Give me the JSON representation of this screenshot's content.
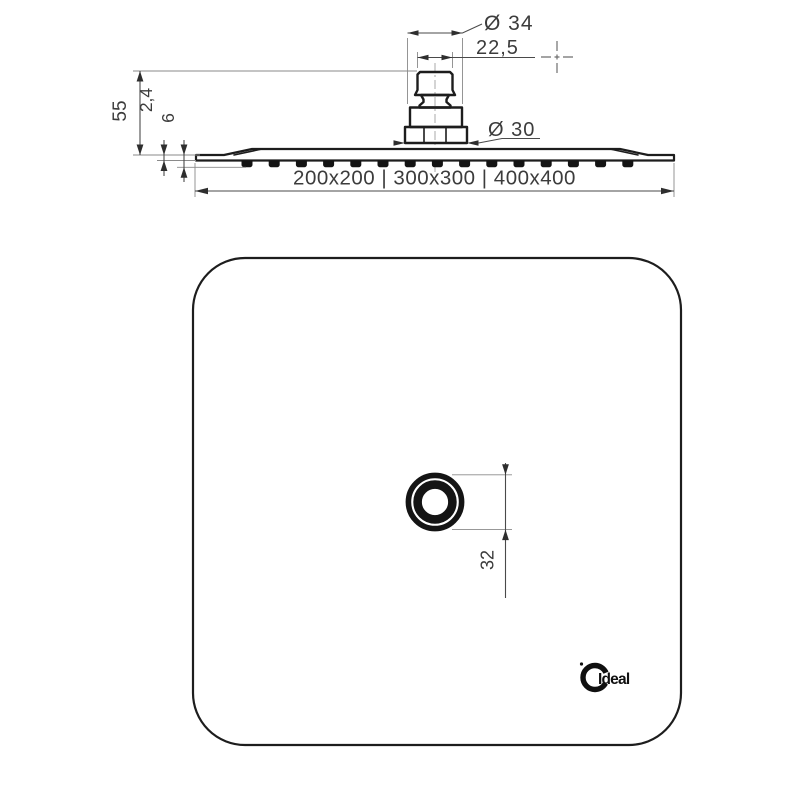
{
  "drawing": {
    "kind": "technical-drawing",
    "subject": "square-rain-shower-head"
  },
  "side_view": {
    "dim_inlet_diameter": "Ø 34",
    "dim_inlet_width": "22,5",
    "dim_connector_diameter": "Ø 30",
    "dim_total_height": "55",
    "dim_plate_thickness": "2,4",
    "dim_plate_with_nozzles": "6",
    "sizes_label": "200x200 | 300x300 | 400x400",
    "sizes": [
      "200x200",
      "300x300",
      "400x400"
    ],
    "nozzle_count": 15
  },
  "plan_view": {
    "dim_outlet": "32",
    "brand_label": "Ideal"
  },
  "colors": {
    "geometry_line": "#1d1d1d",
    "dimension_line": "#4a4a4a",
    "extension_line": "#8a8a8a",
    "background": "#ffffff"
  }
}
